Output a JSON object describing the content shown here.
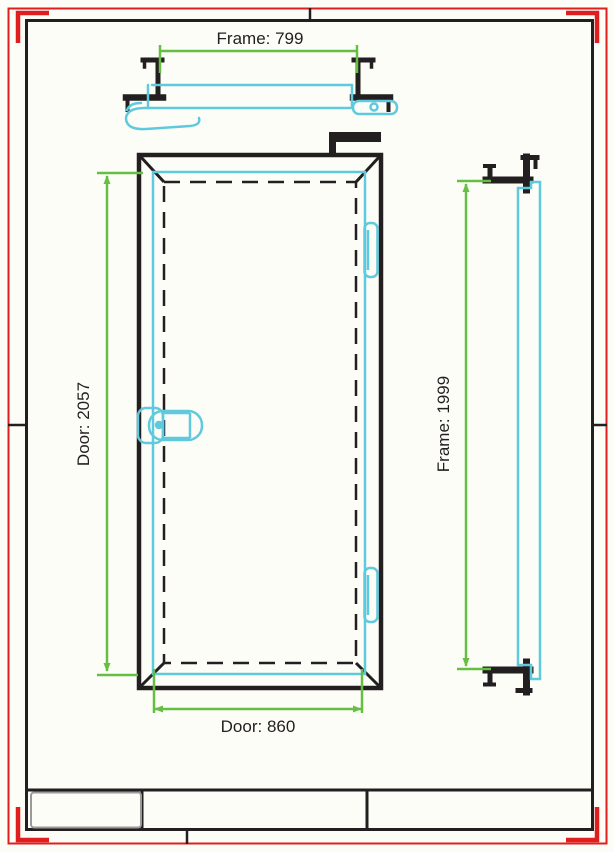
{
  "sheet": {
    "background": "#fdfdf8",
    "border_color": "#e01e1e",
    "line_color": "#231f20",
    "panel_color": "#5fc9de",
    "dimension_color": "#66bf43",
    "title_cell_highlight": "#9a9a9a"
  },
  "views": {
    "top_section": {
      "dimension_label": "Frame: 799"
    },
    "elevation": {
      "height_dimension_label": "Door: 2057",
      "width_dimension_label": "Door: 860"
    },
    "side_section": {
      "dimension_label": "Frame: 1999"
    }
  },
  "title_block": {
    "cells": [
      "",
      "",
      ""
    ]
  }
}
